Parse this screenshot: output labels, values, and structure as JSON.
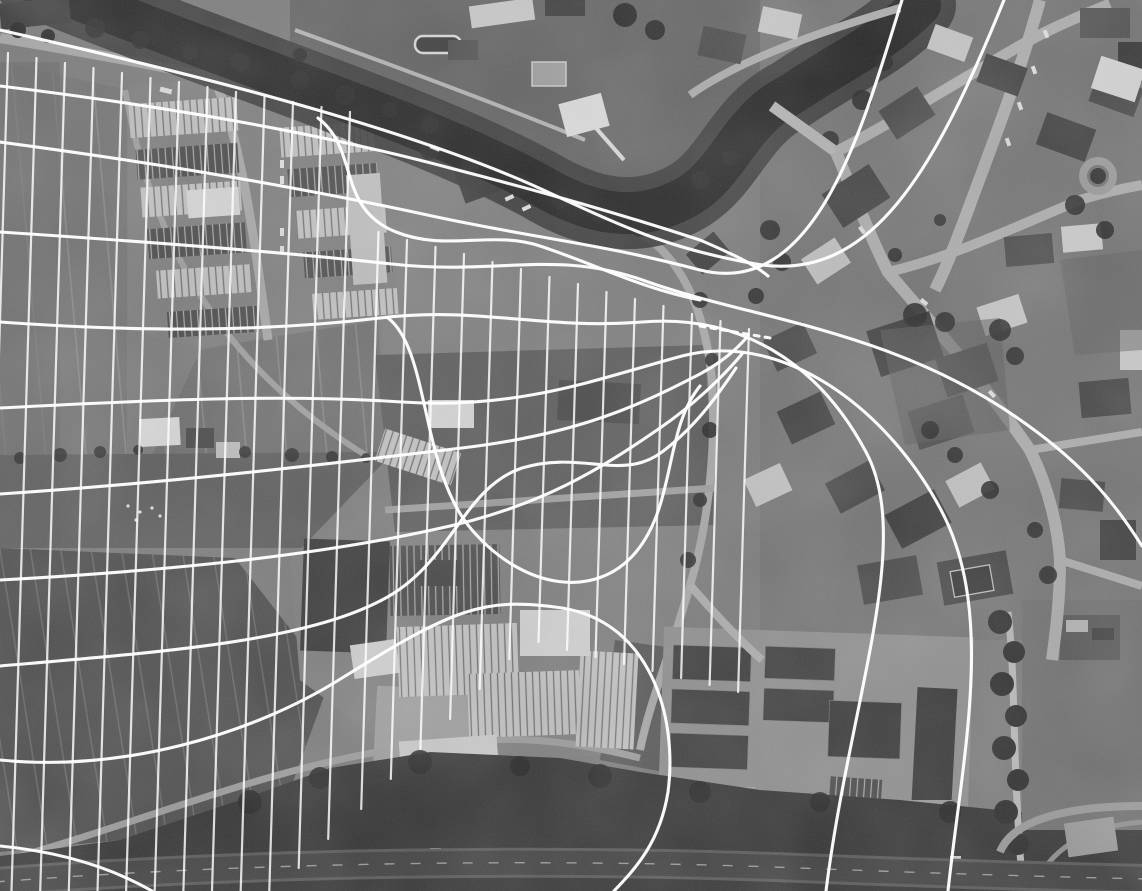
{
  "meta": {
    "title": "Grayscale aerial photograph with white flow-line overlay",
    "width": 1142,
    "height": 891,
    "visible_text": "none"
  },
  "palette": {
    "base_gray": "#7b7b7b",
    "field_gray": "#737373",
    "dark_field_gray": "#4c4c4c",
    "scrub_gray": "#5f5f5f",
    "water_gray": "#242424",
    "bank_gray": "#383838",
    "woodland_gray": "#333333",
    "road_gray": "#a8a8a8",
    "highway_gray": "#3f3f3f",
    "roof_light": "#c6c6c6",
    "roof_dark": "#4f4f4f",
    "tree_gray": "#2b2b2b",
    "overlay_white": "#ffffff"
  },
  "scene": {
    "features": [
      {
        "name": "river",
        "label": "meandering river with tree-lined banks, top of frame"
      },
      {
        "name": "footbridge",
        "label": "pedestrian bridge over river, top center"
      },
      {
        "name": "road-bridge",
        "label": "road bridge over river, upper right of center"
      },
      {
        "name": "riverside-pool",
        "label": "outdoor pool on north bank"
      },
      {
        "name": "upper-fields",
        "label": "striped farmland, upper left"
      },
      {
        "name": "lower-fields",
        "label": "dark striped farmland, lower left"
      },
      {
        "name": "farmstead",
        "label": "farm buildings at hedgerow"
      },
      {
        "name": "industrial-estate",
        "label": "warehouse district with striped roofs, center left"
      },
      {
        "name": "town-center",
        "label": "dense town blocks with crossroads, right third"
      },
      {
        "name": "roundabout",
        "label": "tree-ringed junction, center right"
      },
      {
        "name": "barracks-compound",
        "label": "rows of dark sheds, bottom center"
      },
      {
        "name": "sports-court",
        "label": "fenced dark court, bottom center"
      },
      {
        "name": "woodland",
        "label": "dark tree band along bottom"
      },
      {
        "name": "country-road",
        "label": "lane between fields and woods, bottom left"
      },
      {
        "name": "highway",
        "label": "dual carriageway across bottom edge"
      },
      {
        "name": "flow-overlay",
        "label": "white streamline grid converging to a neck then fanning out"
      }
    ]
  },
  "overlay": {
    "stroke_color": "#ffffff",
    "vertical_grid": {
      "stroke_width": 2.2,
      "opacity": 0.82,
      "lean": 0.03,
      "lines": [
        [
          8,
          53,
          891
        ],
        [
          36.5,
          58,
          891
        ],
        [
          65,
          63,
          891
        ],
        [
          93.5,
          68,
          891
        ],
        [
          122,
          73,
          891
        ],
        [
          150.5,
          78,
          891
        ],
        [
          179,
          82,
          891
        ],
        [
          207.5,
          87,
          891
        ],
        [
          236,
          92,
          891
        ],
        [
          264.5,
          97,
          891
        ],
        [
          293,
          102,
          891
        ],
        [
          321.5,
          107,
          868
        ],
        [
          350,
          112,
          839
        ],
        [
          378.5,
          232,
          809
        ],
        [
          407,
          240,
          779
        ],
        [
          435.5,
          247,
          749
        ],
        [
          464,
          254,
          719
        ],
        [
          492.5,
          262,
          689
        ],
        [
          521,
          269,
          659
        ],
        [
          549.5,
          277,
          642
        ],
        [
          578,
          284,
          650
        ],
        [
          606.5,
          292,
          657
        ],
        [
          635,
          299,
          664
        ],
        [
          663.5,
          306,
          671
        ],
        [
          692,
          314,
          678
        ],
        [
          720.5,
          321,
          685
        ],
        [
          749,
          329,
          692
        ]
      ]
    },
    "streamlines": {
      "stroke_width": 3.1,
      "opacity": 0.96,
      "paths": [
        "M0,30 C230,82 430,136 552,194 C634,232 676,250 756,264 C872,284 936,168 1004,0",
        "M0,86 C180,108 330,136 450,168 C550,194 620,214 700,240 C742,258 756,266 768,276",
        "M0,142 C180,166 322,192 432,216 C534,238 602,244 700,270 C818,300 864,122 902,0",
        "M0,232 C152,242 282,252 392,264 C500,276 556,248 648,282 C756,320 896,330 1026,424 C1088,468 1118,508 1142,546",
        "M0,322 C140,332 262,332 380,318 C478,306 544,330 642,322 C740,314 818,362 866,452 C914,542 850,700 826,891",
        "M0,408 C152,400 282,394 402,402 C520,410 600,378 682,356 C790,328 898,420 946,520 C994,622 962,760 948,891",
        "M0,494 C182,482 342,462 462,448 C580,434 642,404 700,374 C722,362 736,350 748,336",
        "M0,580 C182,570 322,554 432,530 C540,508 602,468 660,428 C692,406 722,378 742,354",
        "M0,666 C162,652 302,642 382,600 C452,564 462,488 522,468 C582,450 622,482 662,452 C694,428 716,398 736,368",
        "M388,318 C430,350 420,470 472,530 C524,590 596,600 636,552 C676,504 664,430 700,386",
        "M318,118 C360,150 336,208 396,232 C446,252 492,230 540,246 C600,266 640,288 700,300",
        "M0,760 C120,772 250,736 342,678 C452,610 482,596 562,608 C650,622 678,716 668,792 C660,842 636,868 614,891",
        "M0,846 C62,852 112,868 152,891"
      ]
    },
    "neck_dashes": {
      "path": "M700,326 L770,338",
      "dash": "5 6",
      "stroke_width": 3,
      "opacity": 0.95
    }
  }
}
